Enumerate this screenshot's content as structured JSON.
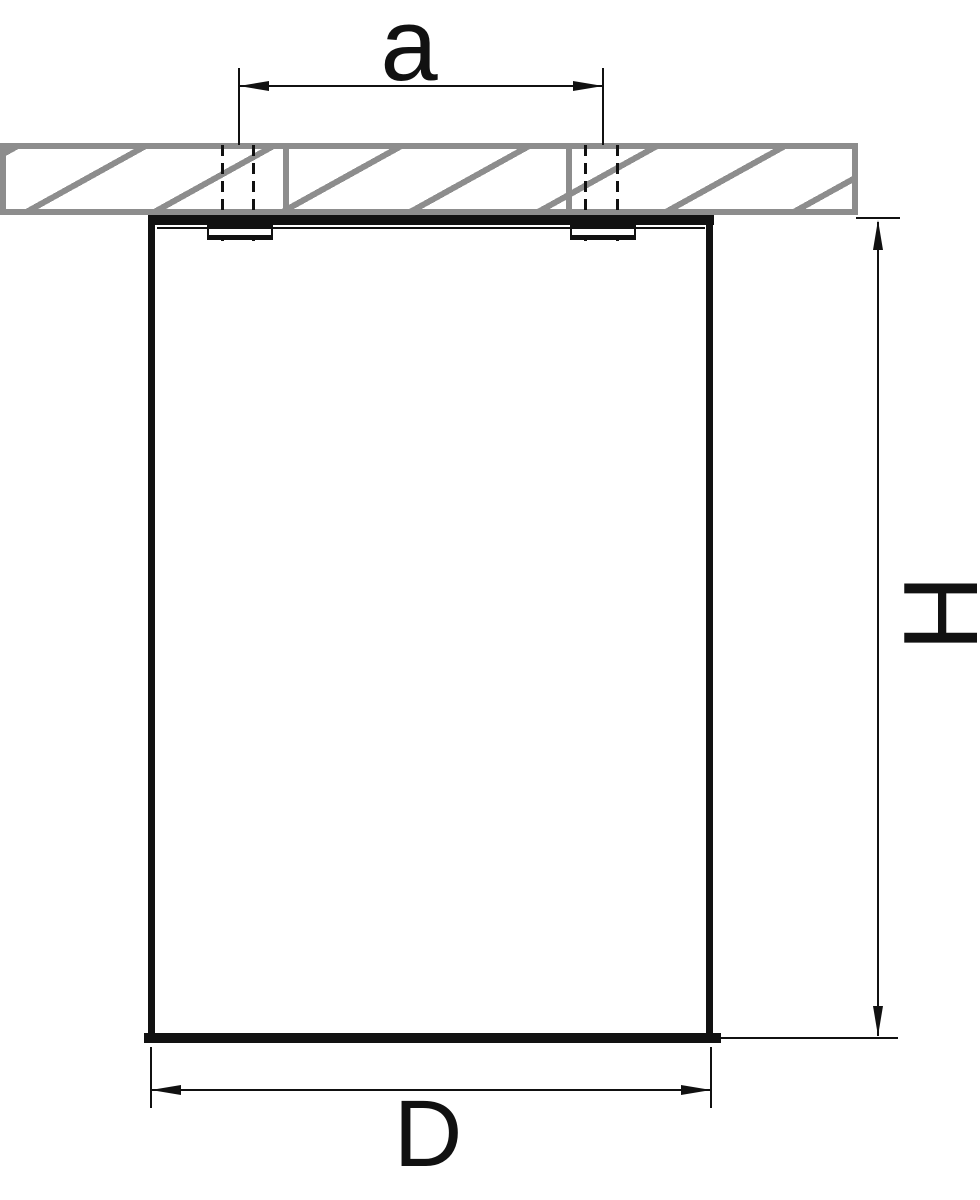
{
  "colors": {
    "line": "#111111",
    "hatch": "#8d8d8d",
    "bg": "#ffffff"
  },
  "dimensions": {
    "hole_spacing": {
      "label": "a"
    },
    "height": {
      "label": "H"
    },
    "diameter": {
      "label": "D"
    }
  }
}
